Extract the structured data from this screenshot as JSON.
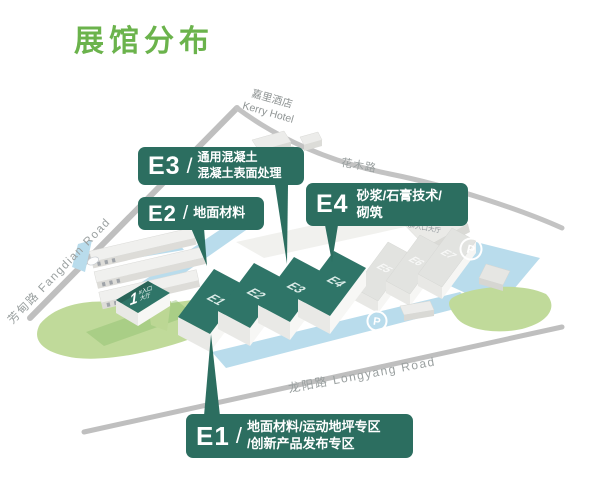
{
  "title": "展馆分布",
  "theme": {
    "title_green": "#6bb34c",
    "callout_teal": "#2c6e60",
    "hall_teal": "#2f7568",
    "water_blue": "#b9dcec",
    "lawn_green": "#c0da9a",
    "road_gray": "#bfbfbf"
  },
  "callouts": {
    "e3": {
      "num": "E3",
      "slash": "/",
      "line1": "通用混凝土",
      "line2": "混凝土表面处理"
    },
    "e2": {
      "num": "E2",
      "slash": "/",
      "line1": "地面材料",
      "line2": ""
    },
    "e4": {
      "num": "E4",
      "slash": "",
      "line1": "砂浆/石膏技术/",
      "line2": "砌筑"
    },
    "e1": {
      "num": "E1",
      "slash": "/",
      "line1": "地面材料/运动地坪专区",
      "line2": "/创新产品发布专区"
    }
  },
  "halls": {
    "e1": "E1",
    "e2": "E2",
    "e3": "E3",
    "e4": "E4",
    "e5": "E5",
    "e6": "E6",
    "e7": "E7"
  },
  "map": {
    "hotel_cn": "嘉里酒店",
    "hotel_en": "Kerry Hotel",
    "road_left": "芳甸路 Fangdian Road",
    "road_top": "花木路",
    "road_bottom": "龙阳路  Longyang Road",
    "entrance1_num": "1",
    "entrance1_line1": "#入口",
    "entrance1_line2": "大厅",
    "entrance3": "3#入口大厅",
    "parking": "P"
  }
}
